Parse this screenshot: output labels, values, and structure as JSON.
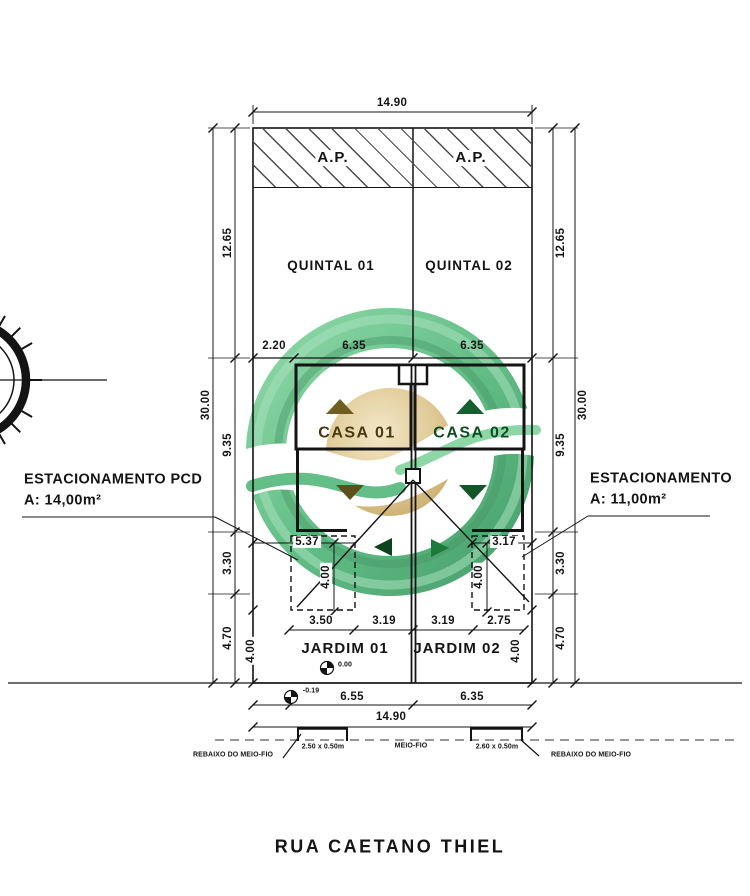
{
  "street_name": "RUA CAETANO THIEL",
  "areas": {
    "ap_left": "A.P.",
    "ap_right": "A.P.",
    "quintal1": "QUINTAL 01",
    "quintal2": "QUINTAL 02",
    "casa1": "CASA 01",
    "casa2": "CASA 02",
    "jardim1": "JARDIM 01",
    "jardim2": "JARDIM 02"
  },
  "annotations": {
    "parking_left_line1": "ESTACIONAMENTO PCD",
    "parking_left_line2": "A: 14,00m²",
    "parking_right_line1": "ESTACIONAMENTO",
    "parking_right_line2": "A: 11,00m²",
    "curb_label": "MEIO-FIO",
    "curb_lowering_left": "REBAIXO DO MEIO-FIO",
    "curb_lowering_right": "REBAIXO DO MEIO-FIO",
    "ramp_left": "2.50 x 0.50m",
    "ramp_right": "2.60 x 0.50m",
    "level_lot": "0.00",
    "level_street": "-0.19"
  },
  "dimensions": {
    "top_width": "14.90",
    "bottom_width": "14.90",
    "left": {
      "d1": "12.65",
      "d2": "9.35",
      "d3": "3.30",
      "d4": "4.70",
      "total": "30.00"
    },
    "right": {
      "d1": "12.65",
      "d2": "9.35",
      "d3": "3.30",
      "d4": "4.70",
      "total": "30.00"
    },
    "mid_row": [
      "2.20",
      "6.35",
      "6.35"
    ],
    "parking": {
      "left_width": "5.37",
      "right_width": "3.17",
      "left_depth": "4.00",
      "right_depth": "4.00"
    },
    "front_row": [
      "3.50",
      "3.19",
      "3.19",
      "2.75"
    ],
    "jardim": {
      "left_depth": "4.00",
      "right_depth": "4.00"
    },
    "street_row": [
      "6.55",
      "6.35"
    ]
  },
  "colors": {
    "line": "#141414",
    "watermark_green": "#4FB677",
    "watermark_green_light": "#9ADDB3",
    "watermark_gold": "#DDC389",
    "triangle_left": "#6E5E1F",
    "triangle_right": "#16602F"
  }
}
